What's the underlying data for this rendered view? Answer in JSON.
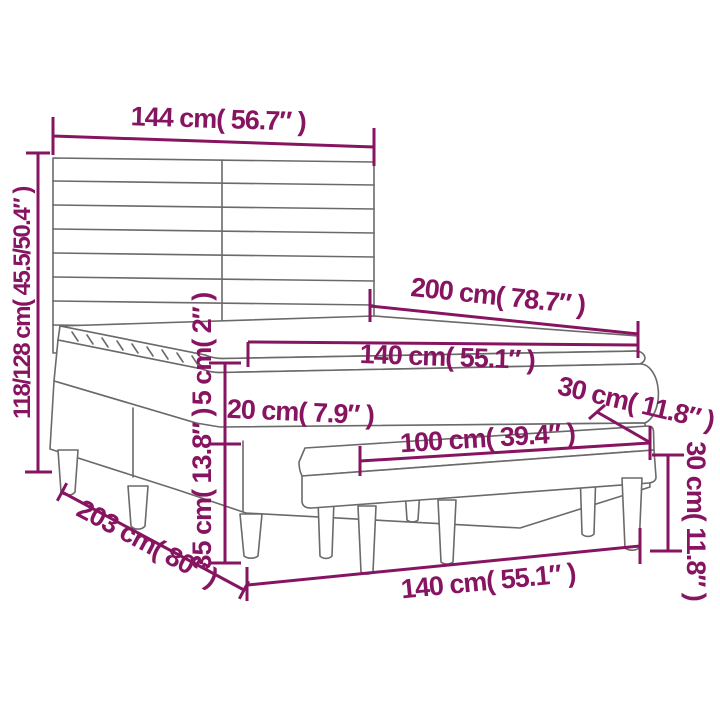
{
  "diagram": {
    "type": "furniture-dimension-diagram",
    "subject": "box spring bed with slatted headboard, pillow-top mattress and upholstered bench",
    "colors": {
      "dimension_text": "#871460",
      "drawing_lines": "#6a6a6a",
      "background": "#ffffff"
    },
    "dimensions": [
      {
        "id": "headboard-width",
        "label": "144 cm( 56.7″ )",
        "cm": "144",
        "inches": "56.7"
      },
      {
        "id": "headboard-height",
        "label": "118/128 cm( 45.5/50.4″ )",
        "cm": "118/128",
        "inches": "45.5/50.4"
      },
      {
        "id": "bed-length",
        "label": "200 cm( 78.7″ )",
        "cm": "200",
        "inches": "78.7"
      },
      {
        "id": "mattress-width",
        "label": "140 cm( 55.1″ )",
        "cm": "140",
        "inches": "55.1"
      },
      {
        "id": "topper-thickness",
        "label": "5 cm( 2″ )",
        "cm": "5",
        "inches": "2"
      },
      {
        "id": "mattress-thickness",
        "label": "20 cm( 7.9″ )",
        "cm": "20",
        "inches": "7.9"
      },
      {
        "id": "bench-depth",
        "label": "30 cm( 11.8″ )",
        "cm": "30",
        "inches": "11.8"
      },
      {
        "id": "bench-length",
        "label": "100 cm( 39.4″ )",
        "cm": "100",
        "inches": "39.4"
      },
      {
        "id": "bench-height",
        "label": "30 cm( 11.8″ )",
        "cm": "30",
        "inches": "11.8"
      },
      {
        "id": "base-height",
        "label": "35 cm( 13.8″ )",
        "cm": "35",
        "inches": "13.8"
      },
      {
        "id": "base-length",
        "label": "203 cm( 80″ )",
        "cm": "203",
        "inches": "80"
      },
      {
        "id": "bed-width",
        "label": "140 cm( 55.1″ )",
        "cm": "140",
        "inches": "55.1"
      }
    ]
  }
}
